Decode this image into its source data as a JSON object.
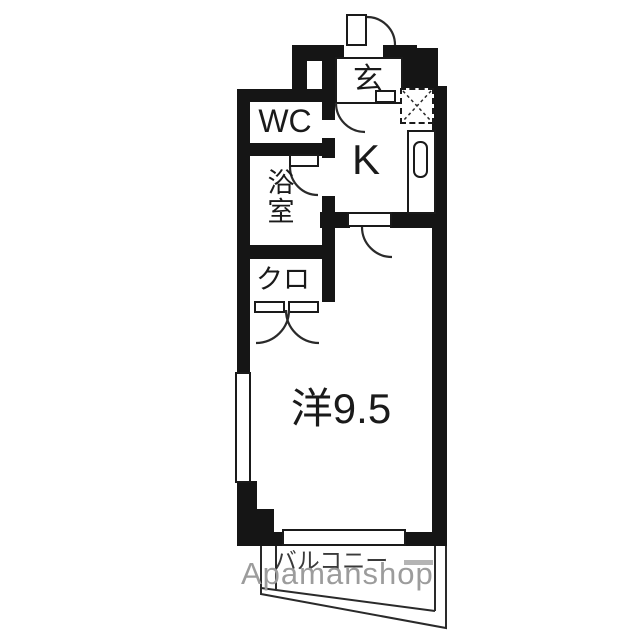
{
  "floorplan": {
    "rooms": {
      "genkan": "玄",
      "wc": "WC",
      "kitchen": "K",
      "bathroom": "浴室",
      "bath_char1": "浴",
      "bath_char2": "室",
      "closet": "クロ",
      "main_room": "洋9.5",
      "balcony": "バルコニー"
    },
    "watermark": "Apamanshop",
    "colors": {
      "wall": "#151515",
      "line": "#2a2a2a",
      "text": "#1a1a1a",
      "balcony-text": "#3a3a3a",
      "watermark": "#9c9c9c",
      "watermark-dash": "#b4b4b4",
      "bg": "#ffffff"
    }
  }
}
